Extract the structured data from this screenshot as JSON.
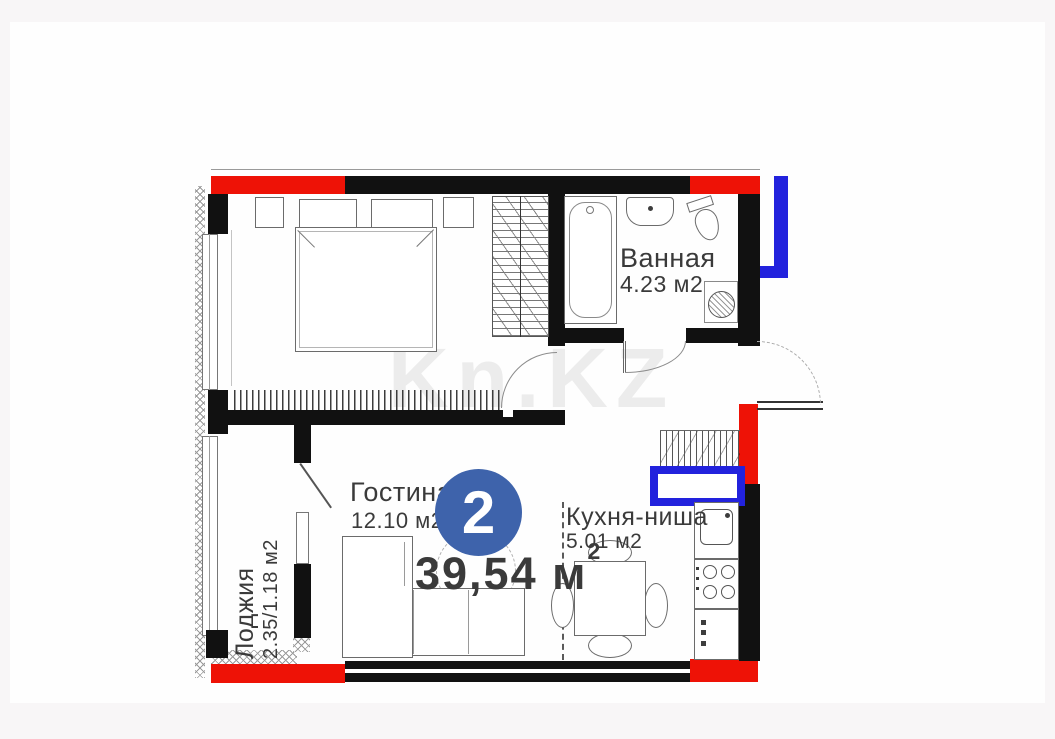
{
  "colors": {
    "wall": "#111111",
    "accent_red": "#ee1206",
    "accent_blue": "#2222dd",
    "badge_blue": "#3e63ab",
    "ink": "#3a3a3a"
  },
  "watermark": {
    "text": "Kn.KZ"
  },
  "plan": {
    "badge_number": "2",
    "total_area": {
      "value": "39,54",
      "unit": "м",
      "superscript": "2"
    },
    "rooms": {
      "bathroom": {
        "name": "Ванная",
        "area": "4.23 м2"
      },
      "living_room": {
        "name": "Гостиная",
        "area": "12.10 м2"
      },
      "kitchen_niche": {
        "name": "Кухня-ниша",
        "area": "5.01 м2"
      },
      "loggia": {
        "name": "Лоджия",
        "area": "2.35/1.18 м2"
      }
    }
  }
}
